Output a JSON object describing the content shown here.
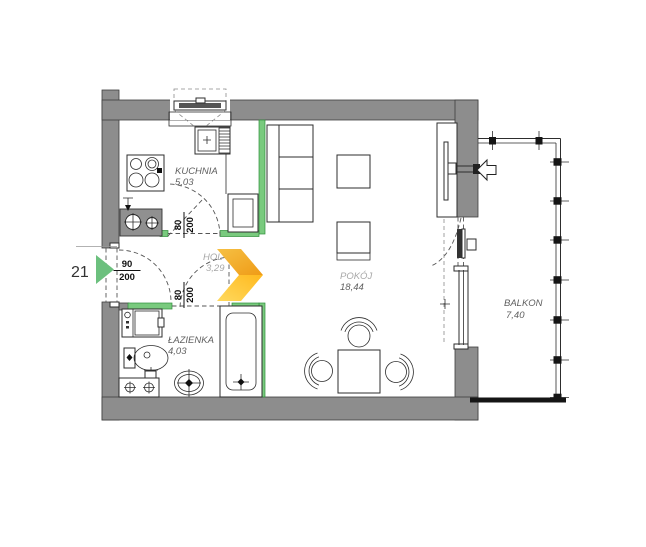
{
  "plan": {
    "unit_number": "21",
    "rooms": {
      "kitchen": {
        "name": "KUCHNIA",
        "area": "5,03"
      },
      "hall": {
        "name": "HOL",
        "area": "3,29"
      },
      "room": {
        "name": "POKÓJ",
        "area": "18,44"
      },
      "bathroom": {
        "name": "ŁAZIENKA",
        "area": "4,03"
      },
      "balcony": {
        "name": "BALKON",
        "area": "7,40"
      }
    },
    "doors": {
      "entrance": {
        "width": "90",
        "height": "200"
      },
      "kitchen": {
        "width": "80",
        "height": "200"
      },
      "bathroom": {
        "width": "80",
        "height": "200"
      }
    },
    "colors": {
      "wall_gray": "#8d8d8d",
      "partition_green": "#79ca7e",
      "entrance_marker_green": "#6cc07e",
      "logo_orange": "#f29c1f",
      "logo_yellow": "#ffd24a"
    }
  }
}
